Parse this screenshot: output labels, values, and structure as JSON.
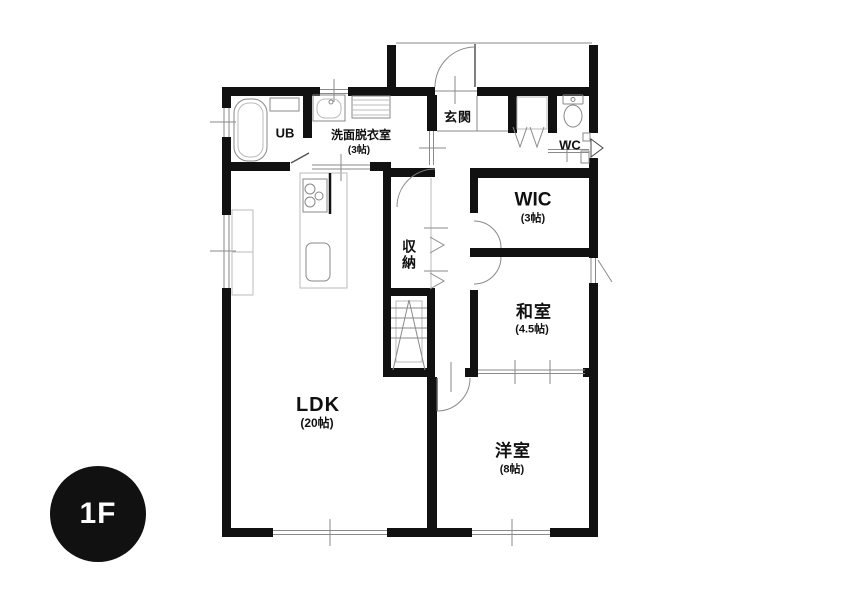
{
  "floor_badge": {
    "label": "1F"
  },
  "rooms": {
    "ldk": {
      "name": "LDK",
      "size": "(20帖)"
    },
    "western_room": {
      "name": "洋室",
      "size": "(8帖)"
    },
    "japanese_room": {
      "name": "和室",
      "size": "(4.5帖)"
    },
    "wic": {
      "name": "WIC",
      "size": "(3帖)"
    },
    "washroom": {
      "name": "洗面脱衣室",
      "size": "(3帖)"
    },
    "unit_bath": {
      "name": "UB"
    },
    "toilet": {
      "name": "WC"
    },
    "entrance": {
      "name": "玄関"
    },
    "storage": {
      "name": "収納"
    }
  },
  "colors": {
    "wall": "#111111",
    "thin_line": "#8a8a8a",
    "badge_background": "#111111",
    "badge_text": "#ffffff",
    "background": "#ffffff"
  }
}
